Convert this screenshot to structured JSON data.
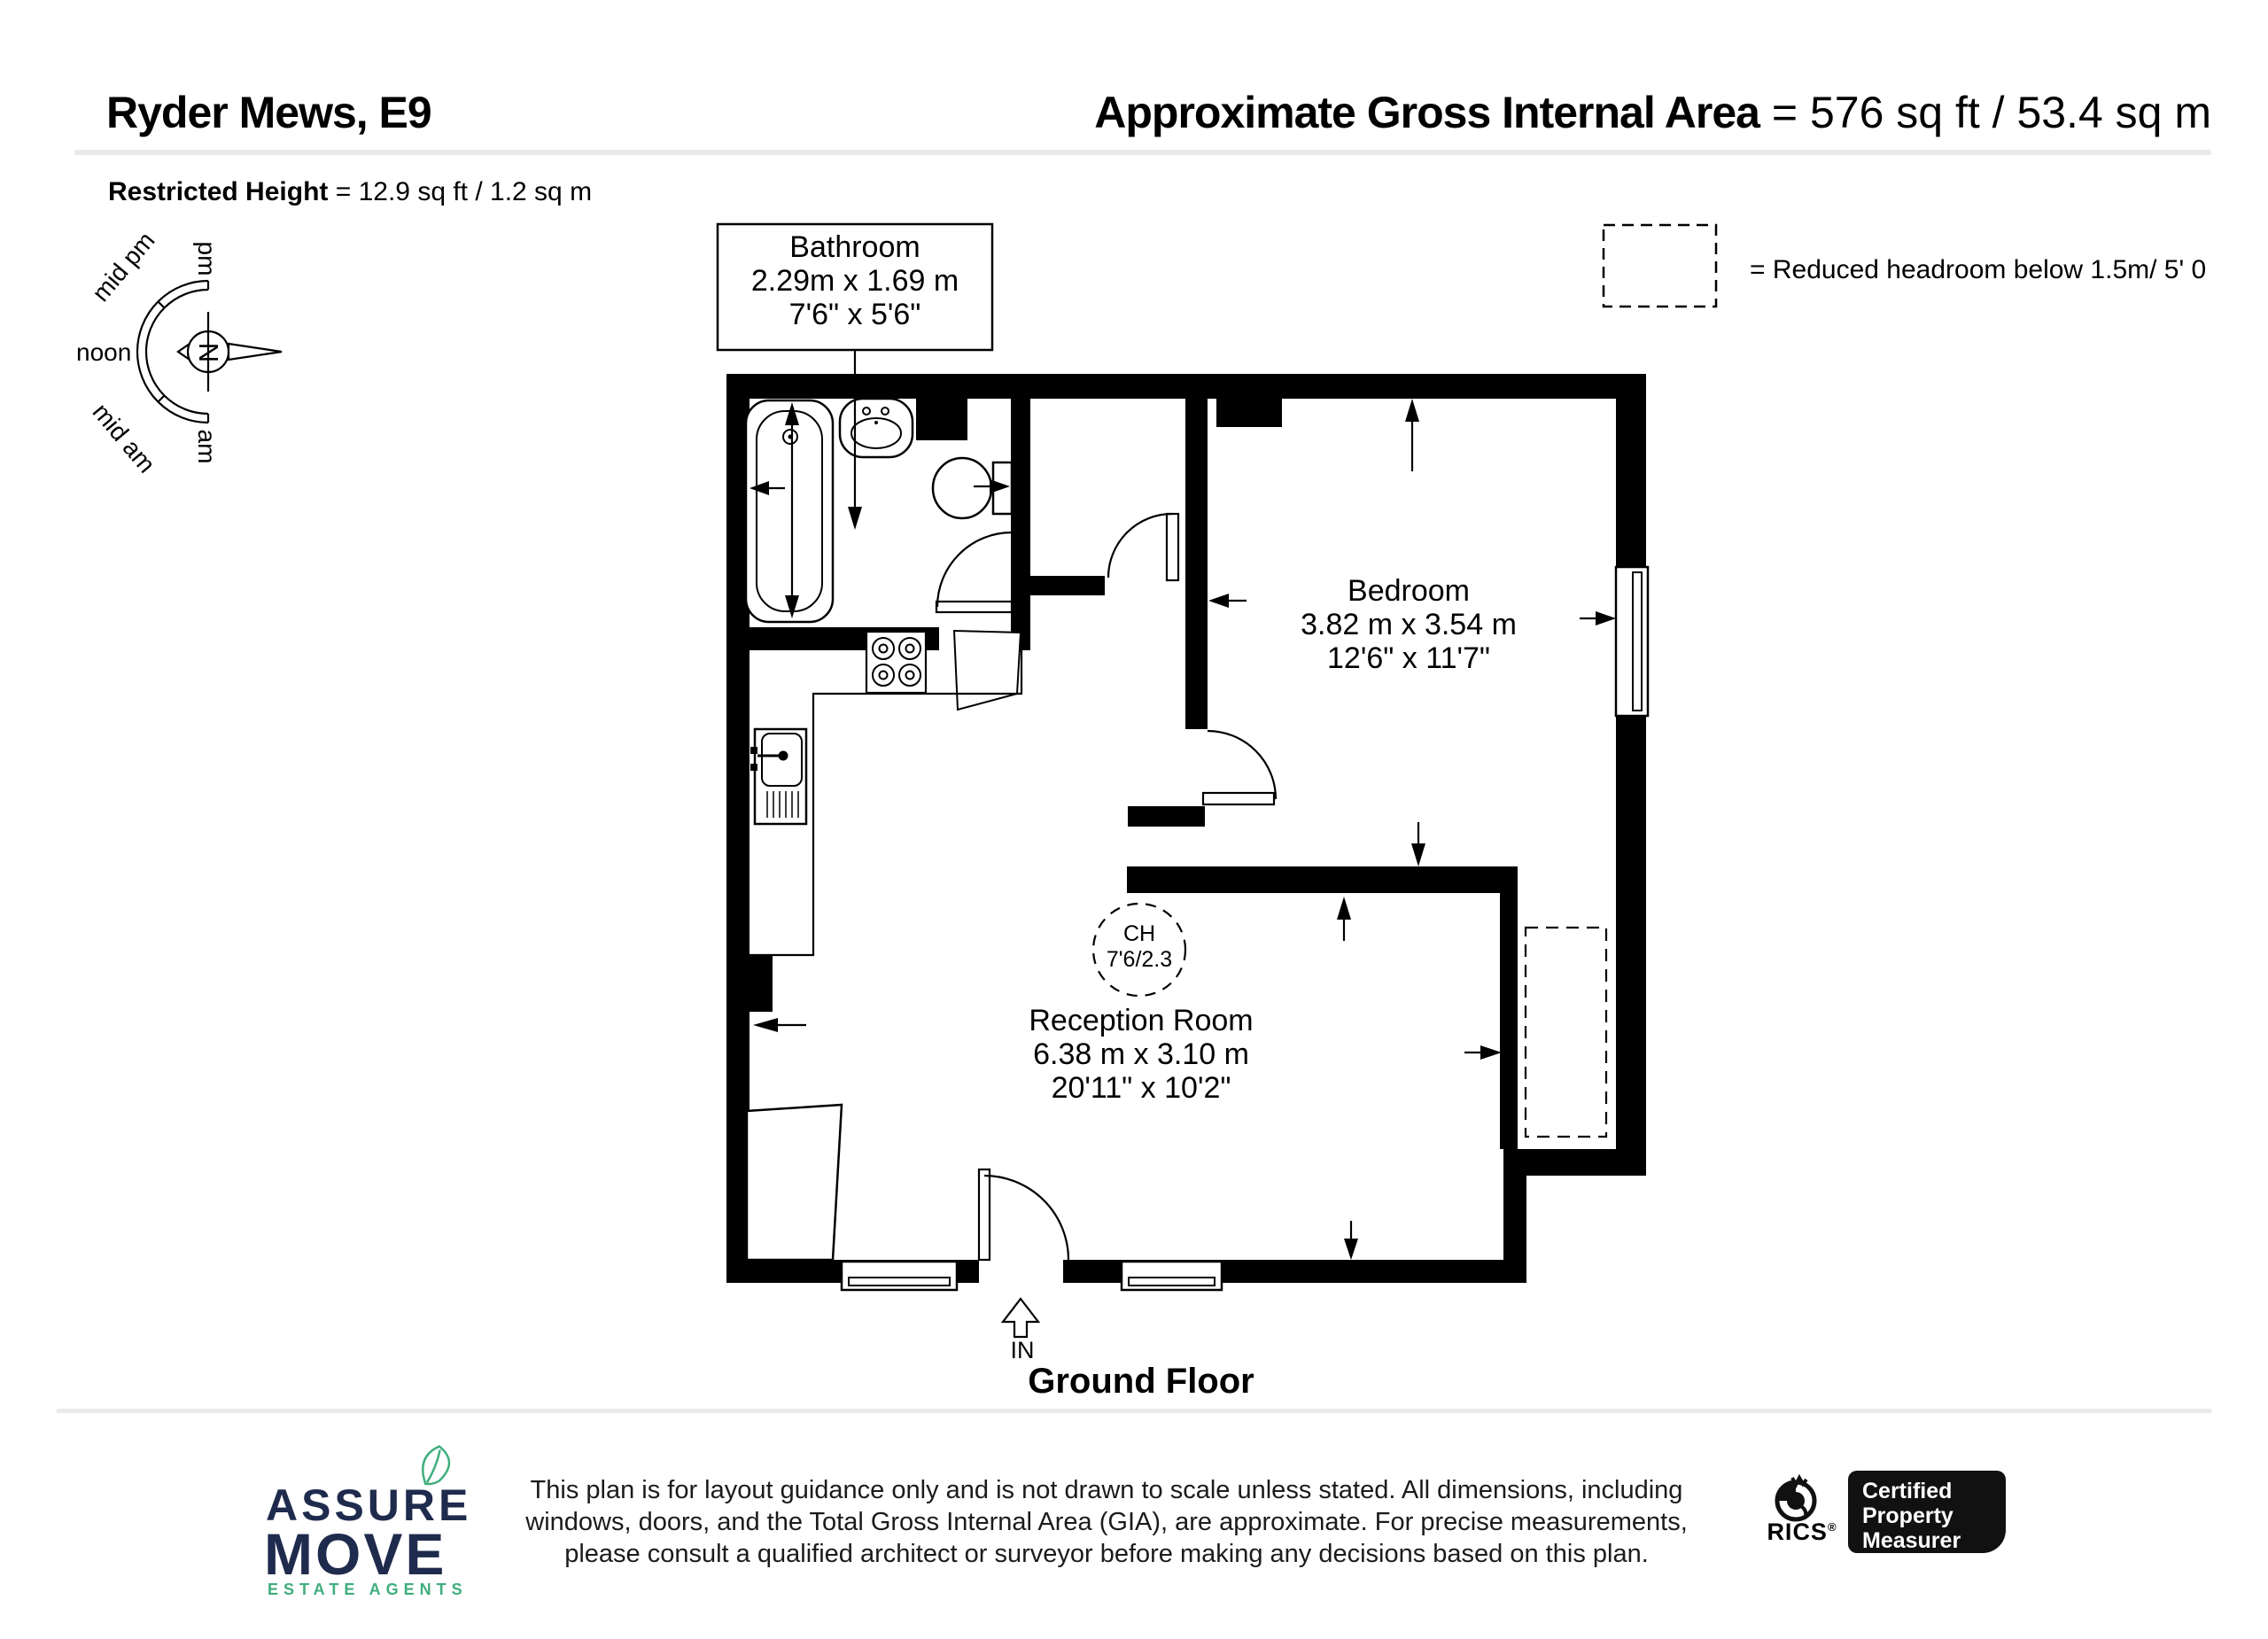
{
  "header": {
    "title": "Ryder Mews, E9",
    "gia_label": "Approximate Gross Internal Area",
    "gia_value": "= 576 sq ft / 53.4 sq m",
    "restricted_label": "Restricted Height",
    "restricted_value": "= 12.9 sq ft / 1.2 sq m"
  },
  "legend": {
    "reduced_headroom": "= Reduced headroom below 1.5m/ 5' 0"
  },
  "compass": {
    "north": "N",
    "pm": "pm",
    "mid_pm": "mid pm",
    "noon": "noon",
    "mid_am": "mid am",
    "am": "am"
  },
  "plan": {
    "floor_label": "Ground Floor",
    "entrance_label": "IN",
    "rooms": [
      {
        "name": "Bathroom",
        "metric": "2.29m x 1.69 m",
        "imperial": "7'6\" x 5'6\""
      },
      {
        "name": "Bedroom",
        "metric": "3.82 m x 3.54 m",
        "imperial": "12'6\" x 11'7\""
      },
      {
        "name": "Reception Room",
        "metric": "6.38 m x 3.10 m",
        "imperial": "20'11\" x 10'2\""
      }
    ],
    "ceiling_height": {
      "line1": "CH",
      "line2": "7'6/2.3"
    }
  },
  "footer": {
    "agency": {
      "name_line1": "ASSURE",
      "name_line2": "MOVE",
      "tagline": "ESTATE AGENTS"
    },
    "disclaimer": {
      "line1": "This plan is for layout guidance only and is not drawn to scale unless stated. All dimensions, including",
      "line2": "windows, doors, and the Total Gross Internal Area (GIA), are approximate. For precise measurements,",
      "line3": "please consult a qualified architect or surveyor before making any decisions based on this plan."
    },
    "rics": {
      "name": "RICS",
      "registered": "®",
      "cert_line1": "Certified",
      "cert_line2": "Property",
      "cert_line3": "Measurer"
    }
  },
  "colors": {
    "wall": "#000000",
    "navy": "#1f2b4d",
    "green": "#3fae7c",
    "separator": "#eaeaea",
    "cert_bg": "#111111"
  }
}
